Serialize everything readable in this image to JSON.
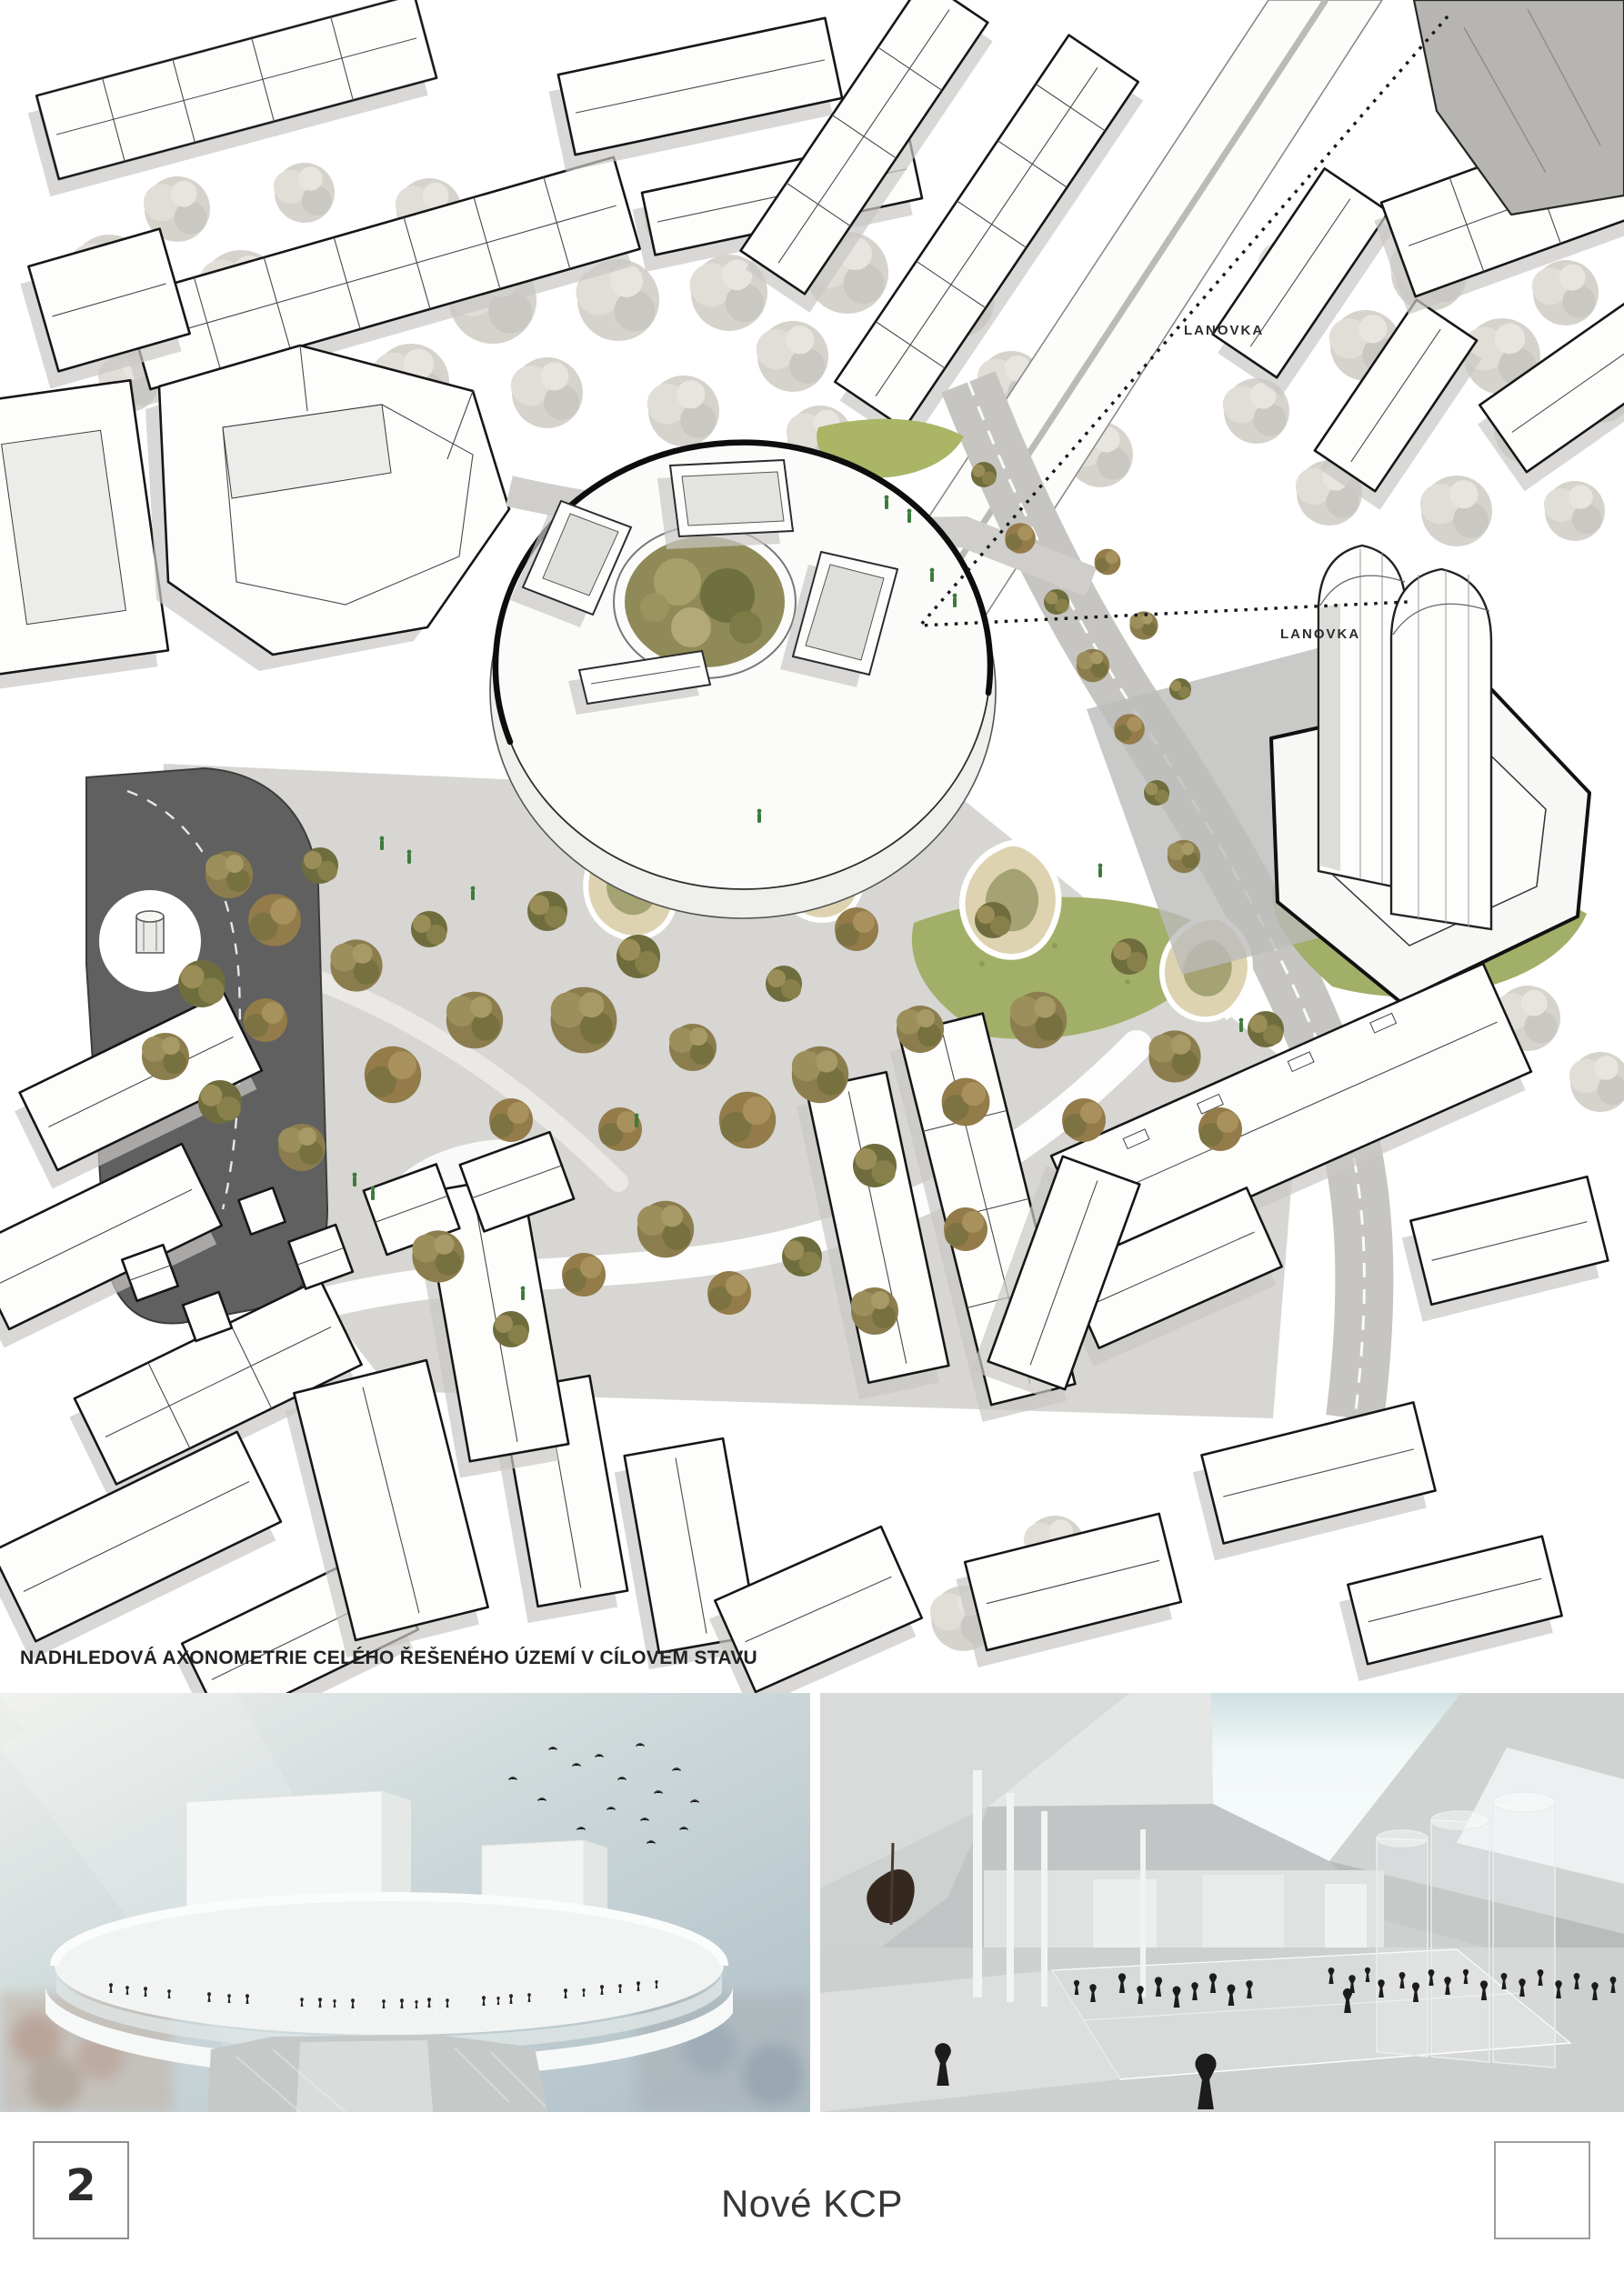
{
  "axon": {
    "caption": "NADHLEDOVÁ AXONOMETRIE CELÉHO ŘEŠENÉHO ÚZEMÍ V CÍLOVEM STAVU",
    "lanovka_label_upper": "LANOVKA",
    "lanovka_label_lower": "LANOVKA"
  },
  "footer": {
    "page_number": "2",
    "project_title": "Nové KCP"
  },
  "colors": {
    "paper": "#ffffff",
    "ink": "#1a1a1a",
    "plaza_gray": "#d6d5d2",
    "road_dark": "#5f5f5f",
    "island_sand": "#ddd3b1",
    "island_green": "#a5a273",
    "tree_olive": "#8b7d4e",
    "tree_sketch": "#d2cfc8",
    "lawn_green": "#a2af68",
    "render_sky": "#c3d0d6",
    "silhouette": "#1c1c1c"
  }
}
